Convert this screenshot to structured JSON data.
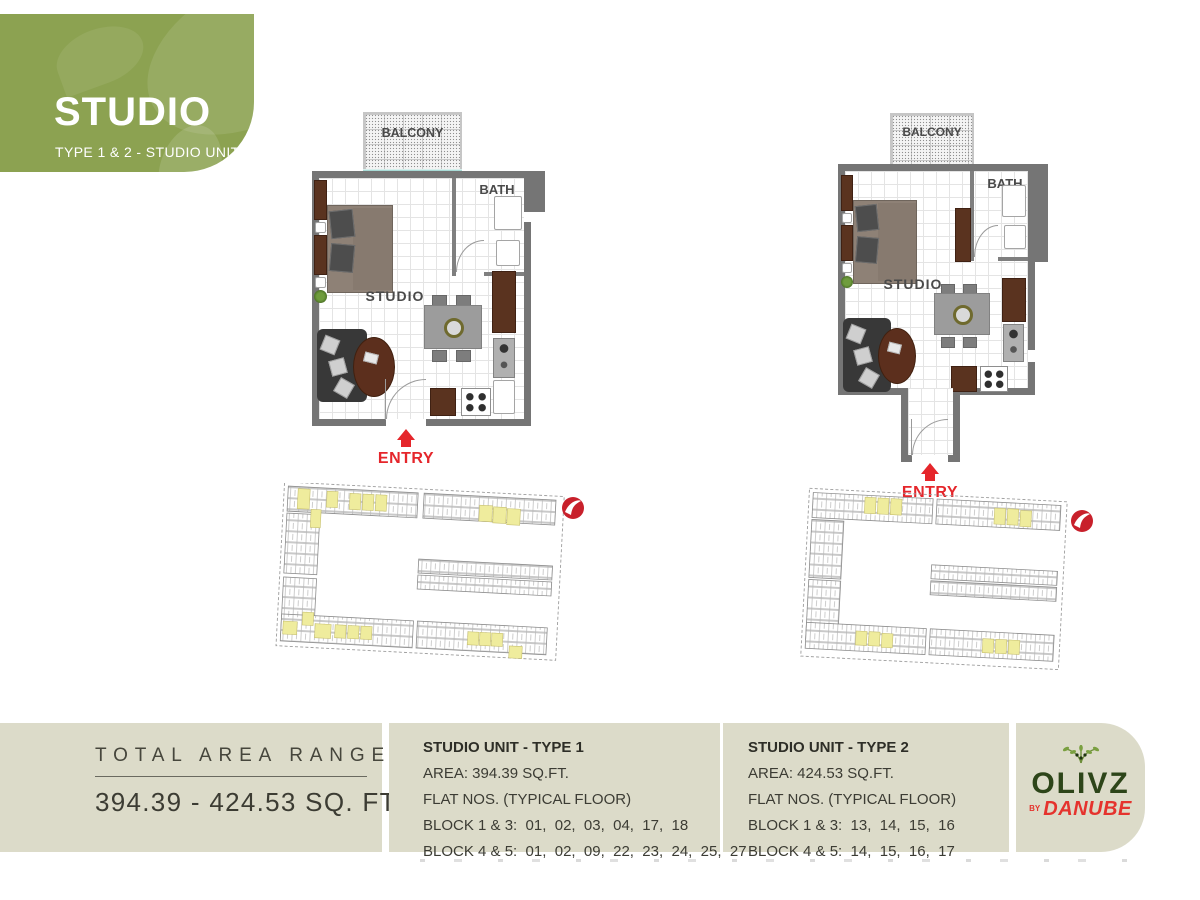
{
  "header": {
    "title": "STUDIO",
    "subtitle": "TYPE 1 & 2 - STUDIO UNIT"
  },
  "plans": [
    {
      "name": "Type 1",
      "labels": {
        "balcony": "BALCONY",
        "bath": "BATH",
        "studio": "STUDIO",
        "entry": "ENTRY"
      }
    },
    {
      "name": "Type 2",
      "labels": {
        "balcony": "BALCONY",
        "bath": "BATH",
        "studio": "STUDIO",
        "entry": "ENTRY"
      }
    }
  ],
  "footer": {
    "total_area": {
      "label": "TOTAL AREA RANGE",
      "value": "394.39 - 424.53 SQ. FT."
    },
    "units": [
      {
        "title": "STUDIO UNIT - TYPE 1",
        "area": "AREA: 394.39 SQ.FT.",
        "flats": "FLAT NOS. (TYPICAL FLOOR)",
        "block13": "BLOCK 1 & 3:  01,  02,  03,  04,  17,  18",
        "block45": "BLOCK 4 & 5:  01,  02,  09,  22,  23,  24,  25,  27"
      },
      {
        "title": "STUDIO UNIT - TYPE 2",
        "area": "AREA: 424.53 SQ.FT.",
        "flats": "FLAT NOS. (TYPICAL FLOOR)",
        "block13": "BLOCK 1 & 3:  13,  14,  15,  16",
        "block45": "BLOCK 4 & 5:  14,  15,  16,  17"
      }
    ],
    "logo": {
      "brand": "OLIVZ",
      "by": "BY",
      "developer": "DANUBE"
    }
  },
  "colors": {
    "banner_green": "#8CA251",
    "footer_beige": "#DCDBC9",
    "accent_red": "#E5262B",
    "wall_gray": "#757575",
    "highlight_yellow": "#EFEC9D",
    "window_teal": "#A8DBD6",
    "logo_green": "#2D4519",
    "logo_red": "#E5332D"
  }
}
